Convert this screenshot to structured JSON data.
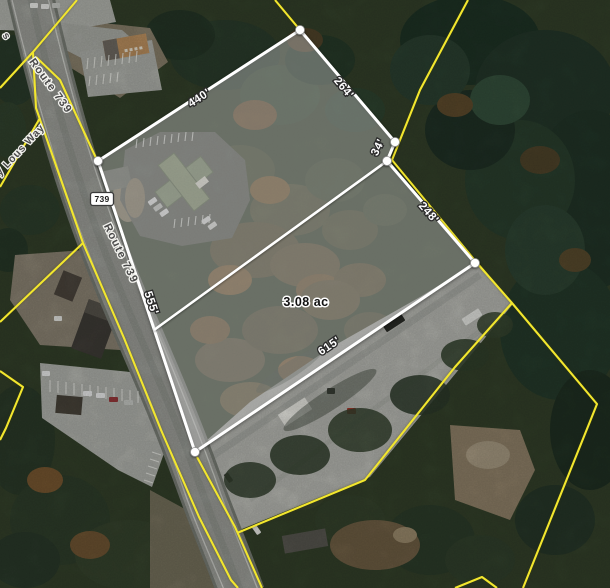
{
  "map": {
    "area_label": "3.08 ac",
    "dimensions": [
      {
        "name": "northwest-edge",
        "text": "440'"
      },
      {
        "name": "northeast-edge",
        "text": "264'"
      },
      {
        "name": "east-jog",
        "text": "34'"
      },
      {
        "name": "east-edge",
        "text": "248'"
      },
      {
        "name": "road-frontage-edge",
        "text": "555'"
      },
      {
        "name": "south-edge",
        "text": "615'"
      }
    ],
    "road_labels": [
      "Route 739",
      "Route 739"
    ],
    "route_shield": "739",
    "street_label": "ry Lous Way",
    "edge_label_fragment": "s",
    "colors": {
      "subject_parcel_line": "#ffffff",
      "other_parcel_line": "#f2e62e",
      "dimension_text": "#ffffff",
      "area_text": "#111111",
      "road_label_text": "#4a4a4a"
    }
  }
}
